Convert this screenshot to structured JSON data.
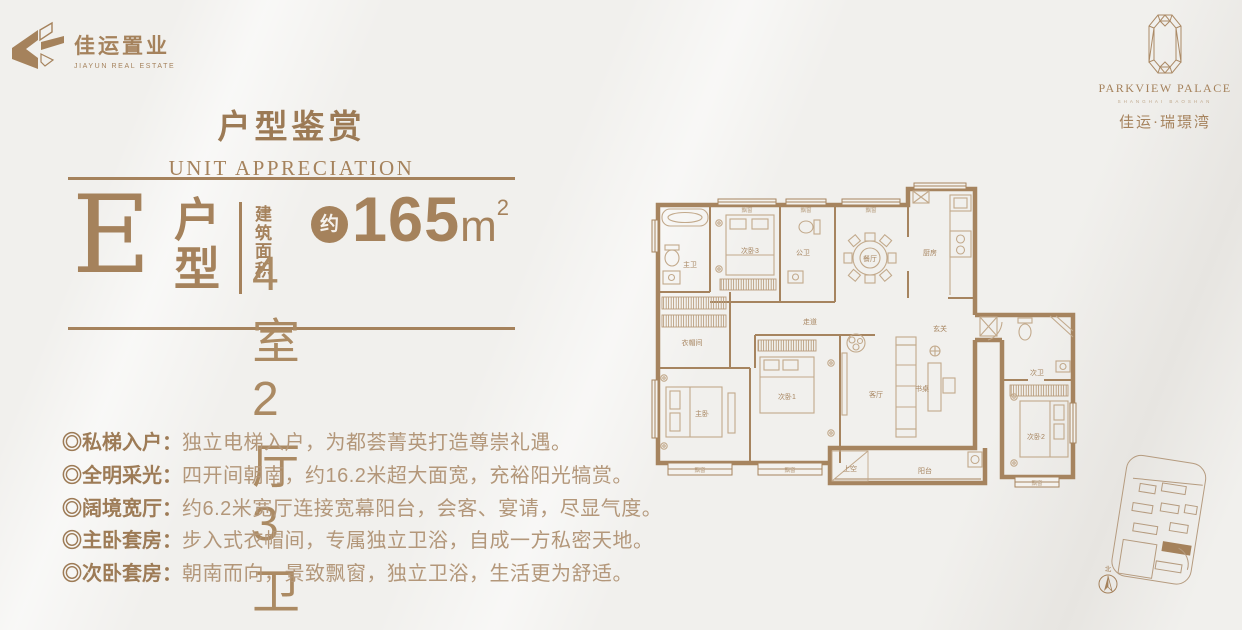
{
  "brand": {
    "name_cn": "佳运置业",
    "name_en": "JIAYUN REAL ESTATE"
  },
  "project": {
    "name_en": "PARKVIEW PALACE",
    "sub_en": "SHANGHAI BAOSHAN",
    "name_cn": "佳运·瑞璟湾"
  },
  "title": {
    "cn": "户型鉴赏",
    "en": "UNIT APPRECIATION"
  },
  "unit": {
    "letter": "E",
    "type_char1": "户",
    "type_char2": "型",
    "area_label_line1": "建筑",
    "area_label_line2": "面积",
    "approx": "约",
    "area_value": "165",
    "area_unit": "m",
    "area_sup": "2",
    "layout": "4室2厅3卫"
  },
  "features": [
    {
      "label": "◎私梯入户：",
      "text": "独立电梯入户，为都荟菁英打造尊崇礼遇。"
    },
    {
      "label": "◎全明采光：",
      "text": "四开间朝南，约16.2米超大面宽，充裕阳光犒赏。"
    },
    {
      "label": "◎阔境宽厅：",
      "text": "约6.2米宽厅连接宽幕阳台，会客、宴请，尽显气度。"
    },
    {
      "label": "◎主卧套房：",
      "text": "步入式衣帽间，专属独立卫浴，自成一方私密天地。"
    },
    {
      "label": "◎次卧套房：",
      "text": "朝南而向，景致飘窗，独立卫浴，生活更为舒适。"
    }
  ],
  "floorplan": {
    "rooms": {
      "master_bath": "主卫",
      "bedroom3": "次卧3",
      "public_bath": "公卫",
      "dining": "餐厅",
      "kitchen": "厨房",
      "entry": "玄关",
      "corridor": "走道",
      "cloakroom": "衣帽间",
      "master_bedroom": "主卧",
      "bedroom1": "次卧1",
      "living": "客厅",
      "desk": "书桌",
      "balcony": "阳台",
      "void": "上空",
      "second_bath": "次卫",
      "bedroom2": "次卧2",
      "bay_window": "飘窗"
    }
  },
  "siteplan": {
    "north_label": "北"
  },
  "colors": {
    "brand_brown": "#a5825c",
    "wall": "#a6845f",
    "furniture": "#c2a98b",
    "background": "#f1f0ed"
  }
}
